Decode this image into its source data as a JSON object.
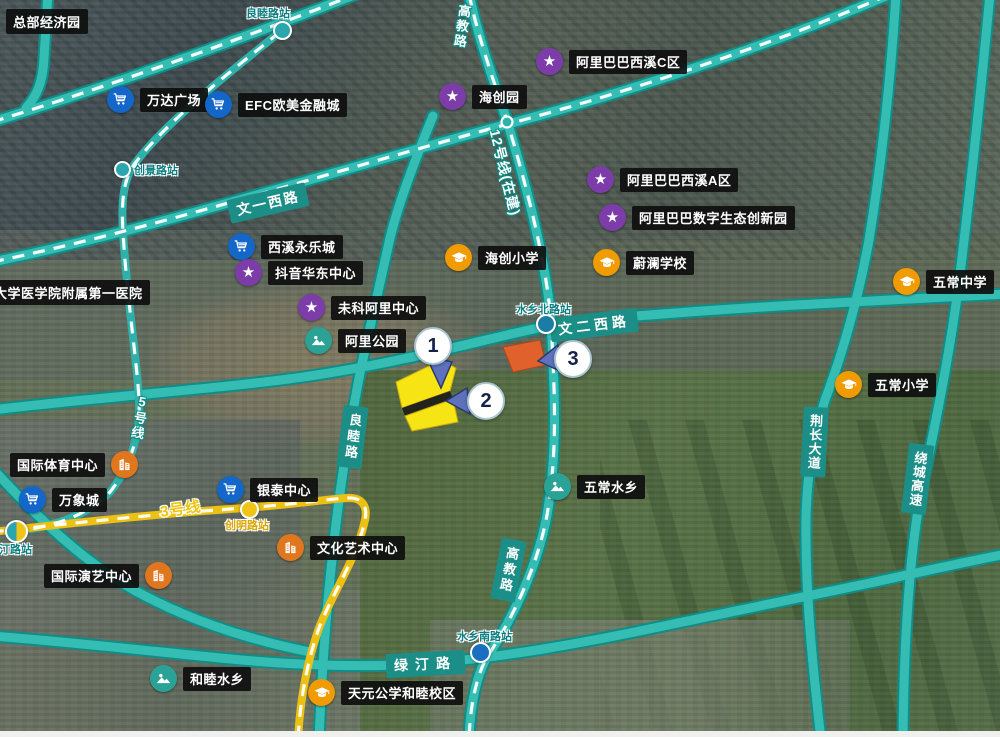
{
  "pois": [
    {
      "id": "wanda-plaza",
      "label": "万达广场",
      "icon": "cart"
    },
    {
      "id": "efc-financial-city",
      "label": "EFC欧美金融城",
      "icon": "cart"
    },
    {
      "id": "xixi-yongle-city",
      "label": "西溪永乐城",
      "icon": "cart"
    },
    {
      "id": "douyin-east-china-center",
      "label": "抖音华东中心",
      "icon": "star"
    },
    {
      "id": "weike-ali-center",
      "label": "未科阿里中心",
      "icon": "star"
    },
    {
      "id": "ali-park",
      "label": "阿里公园",
      "icon": "park"
    },
    {
      "id": "haichuang-park",
      "label": "海创园",
      "icon": "star"
    },
    {
      "id": "alibaba-xixi-c",
      "label": "阿里巴巴西溪C区",
      "icon": "star"
    },
    {
      "id": "alibaba-xixi-a",
      "label": "阿里巴巴西溪A区",
      "icon": "star"
    },
    {
      "id": "alibaba-digital-eco-park",
      "label": "阿里巴巴数字生态创新园",
      "icon": "star"
    },
    {
      "id": "haichuang-primary-school",
      "label": "海创小学",
      "icon": "school"
    },
    {
      "id": "weilan-school",
      "label": "蔚澜学校",
      "icon": "school"
    },
    {
      "id": "wuchang-middle-school",
      "label": "五常中学",
      "icon": "school"
    },
    {
      "id": "wuchang-primary-school",
      "label": "五常小学",
      "icon": "school"
    },
    {
      "id": "wuchang-watertown",
      "label": "五常水乡",
      "icon": "park"
    },
    {
      "id": "intl-sports-center",
      "label": "国际体育中心",
      "icon": "venue"
    },
    {
      "id": "mixc",
      "label": "万象城",
      "icon": "cart"
    },
    {
      "id": "yintai-center",
      "label": "银泰中心",
      "icon": "cart"
    },
    {
      "id": "intl-performing-arts-center",
      "label": "国际演艺中心",
      "icon": "venue"
    },
    {
      "id": "culture-arts-center",
      "label": "文化艺术中心",
      "icon": "venue"
    },
    {
      "id": "hemu-watertown",
      "label": "和睦水乡",
      "icon": "park"
    },
    {
      "id": "tianyuan-school-hemu-campus",
      "label": "天元公学和睦校区",
      "icon": "school"
    }
  ],
  "areas": [
    {
      "id": "headquarters-economy-park",
      "label": "总部经济园"
    },
    {
      "id": "zju-first-affiliated-hospital",
      "label": "浙江大学医学院附属第一医院"
    }
  ],
  "stations": [
    {
      "id": "liangmulu-station",
      "label": "良睦路站"
    },
    {
      "id": "chuangjinglu-station",
      "label": "创景路站"
    },
    {
      "id": "lvtinglu-station",
      "label": "绿汀路站"
    },
    {
      "id": "chuangminglu-station",
      "label": "创明路站"
    },
    {
      "id": "shuixiang-north-station",
      "label": "水乡北路站"
    },
    {
      "id": "shuixiang-south-station",
      "label": "水乡南路站"
    }
  ],
  "road_labels": {
    "wenyi": "文一西路",
    "wener": "文二西路",
    "luting": "绿汀路",
    "liangmu": "良睦路",
    "gaojiao": "高教路",
    "jingchang": "荆长大道",
    "raocheng": "绕城高速"
  },
  "metro_labels": {
    "line5": "5号线",
    "line12": "12号线(在建)",
    "line3": "3号线"
  },
  "markers": [
    {
      "number": "1"
    },
    {
      "number": "2"
    },
    {
      "number": "3"
    }
  ],
  "sites": [
    {
      "marker": "1",
      "color": "#f6e414"
    },
    {
      "marker": "2",
      "color": "#f6e414"
    },
    {
      "marker": "3",
      "color": "#e0612c"
    }
  ],
  "colors": {
    "road_casing": "#0f8d86",
    "road_fill": "#35bdb4",
    "metro_dash": "#ffffff",
    "line3_yellow": "#ecc113",
    "poi_label_bg": "#0e0e0e",
    "road_label_bg": "#1b8e88",
    "cart_icon_bg": "#1467c8",
    "star_icon_bg": "#7d3da8",
    "school_icon_bg": "#f09b00",
    "park_icon_bg": "#2aa396",
    "venue_icon_bg": "#e0761d",
    "marker_pointer": "#5e71bd"
  }
}
